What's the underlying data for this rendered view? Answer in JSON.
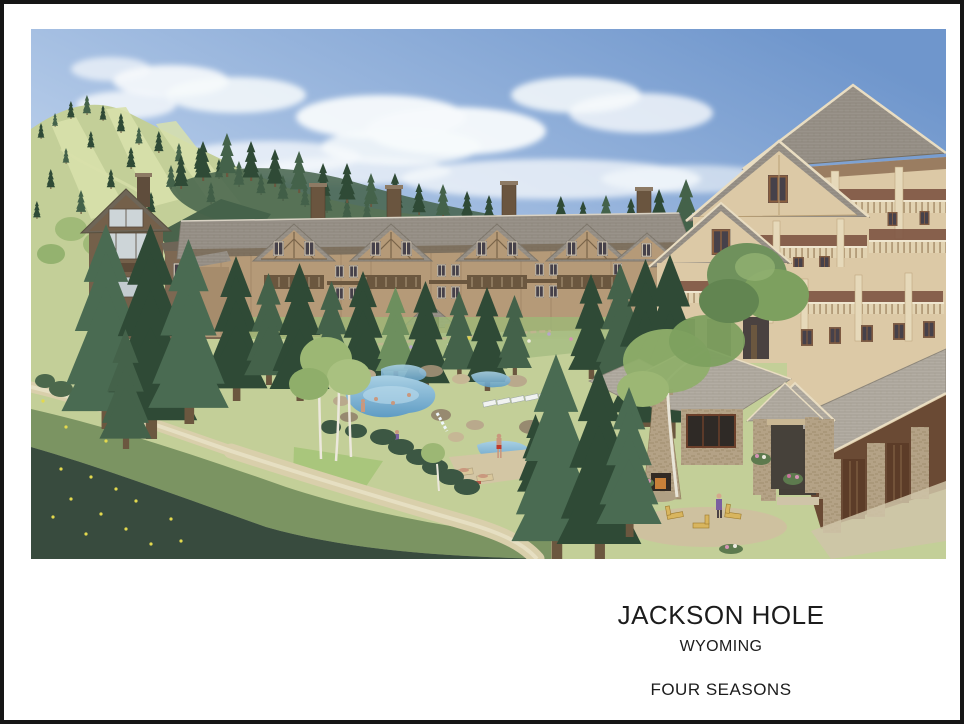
{
  "page": {
    "background": "#ffffff",
    "border_color": "#161616"
  },
  "caption": {
    "title": "JACKSON HOLE",
    "subtitle": "WYOMING",
    "brand": "FOUR SEASONS",
    "ink": "#1c1c1c"
  },
  "illustration": {
    "alt": "Watercolor rendering of a Four Seasons mountain resort: lodge buildings with gabled roofs on a forested ski hill, swimming pools with bathers, stone pool pavilion with outdoor fireplace, evergreen trees, meadow and footpath"
  },
  "colors": {
    "page-bg": "#ffffff",
    "border": "#161616",
    "caption-ink": "#1c1c1c",
    "sky-deep": "#6f96cc",
    "sky-mid": "#b6cce9",
    "sky-pale": "#e3edf6",
    "cloud": "#f7fafc",
    "hill-grass": "#c3cf98",
    "hill-grass-light": "#d8e0ab",
    "forest-dark": "#2f4a36",
    "forest-mid": "#44624a",
    "forest-light": "#6d8f5e",
    "forest-spruce": "#4a6b52",
    "aspen": "#9cb774",
    "meadow-dark": "#32463a",
    "path": "#d9cfab",
    "roof-gray": "#99938a",
    "roof-light": "#b3ada3",
    "wall-tan": "#b59a78",
    "wall-cream": "#dcc9a6",
    "wood-dark": "#6b573f",
    "wood-red": "#7d5443",
    "stone": "#b4a286",
    "window-dark": "#46414a",
    "pool-blue": "#5f9cc4",
    "pool-light": "#a9d0e4",
    "flower-pink": "#d493b4",
    "chair-yellow": "#d8b55e"
  }
}
